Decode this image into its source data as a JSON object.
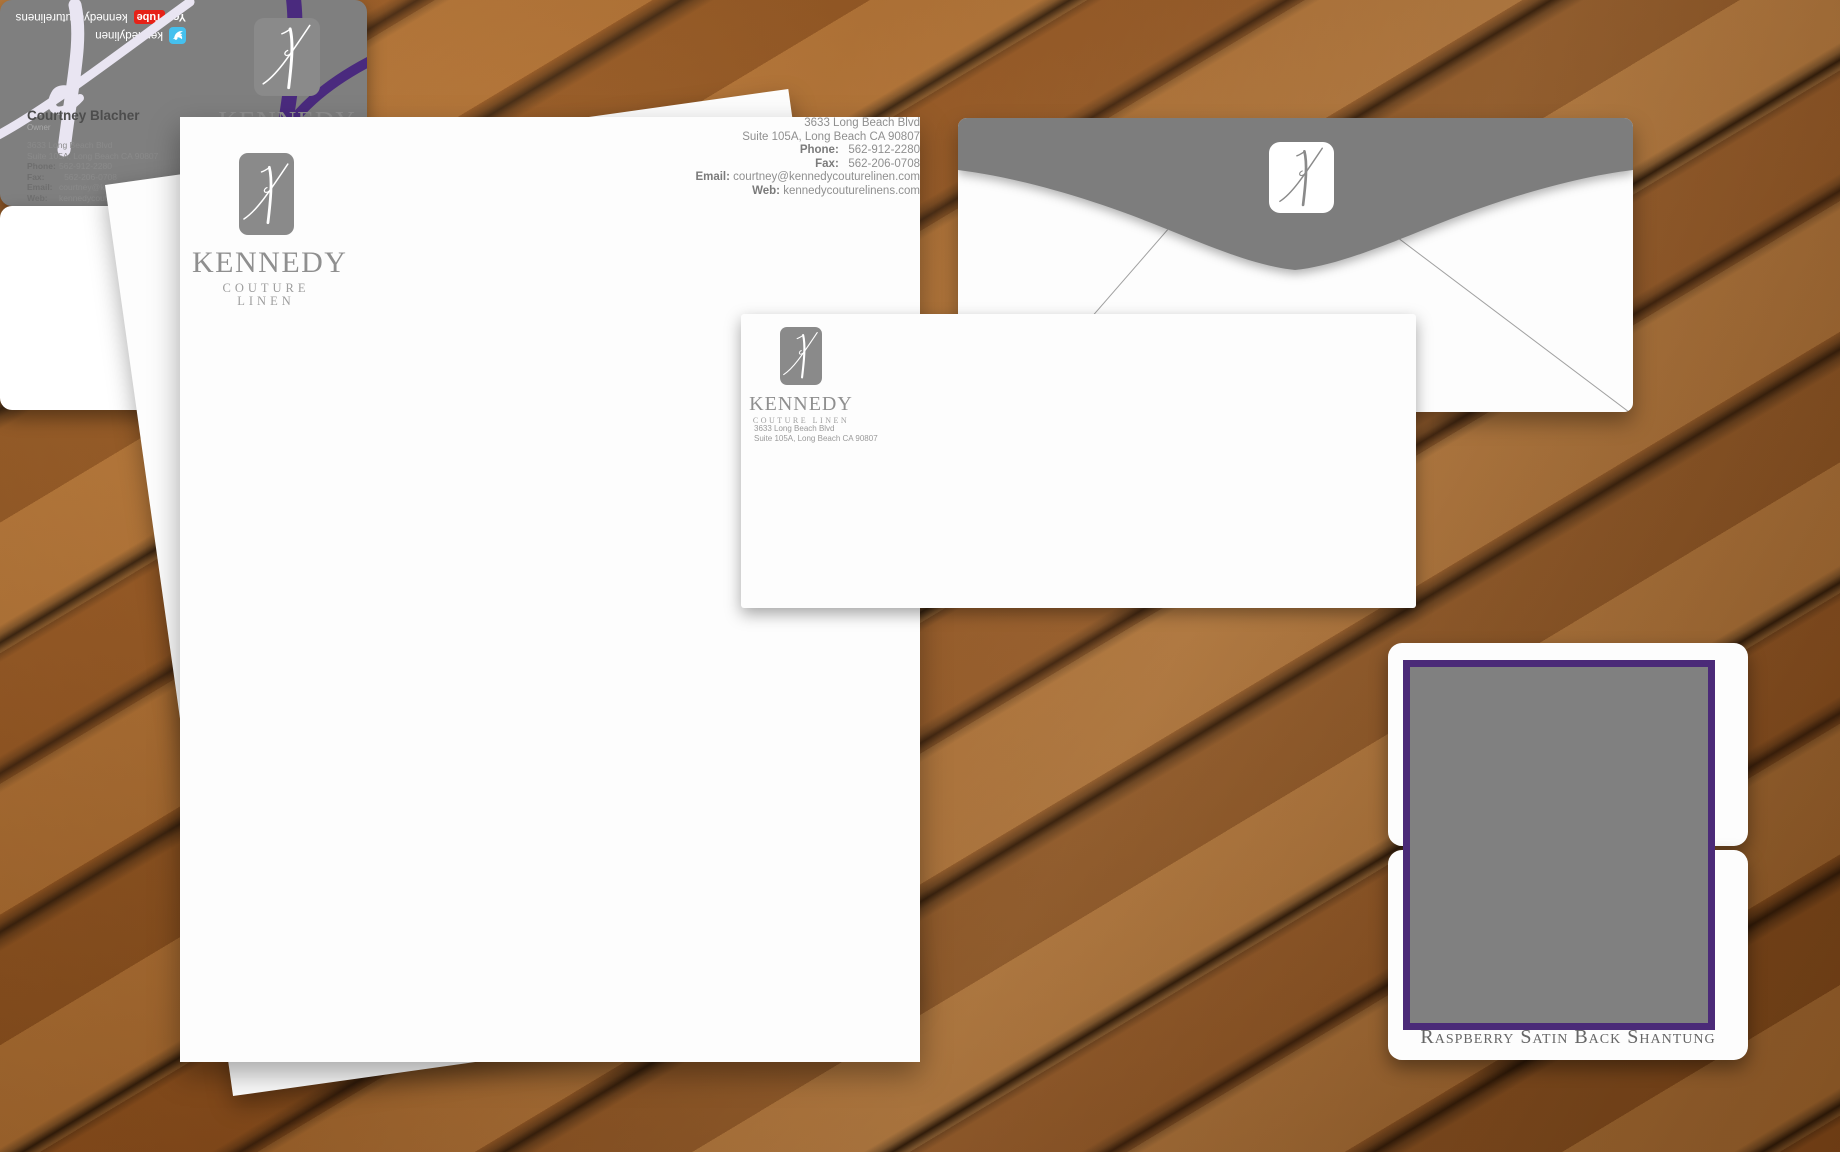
{
  "brand": {
    "name": "KENNEDY",
    "tagline": "COUTURE LINEN",
    "mark": "script-k-icon"
  },
  "contact": {
    "address1": "3633 Long Beach Blvd",
    "address2": "Suite 105A, Long Beach CA 90807",
    "phone_label": "Phone:",
    "phone": "562-912-2280",
    "fax_label": "Fax:",
    "fax": "562-206-0708",
    "email_label": "Email:",
    "email": "courtney@kennedycouturelinen.com",
    "web_label": "Web:",
    "web": "kennedycouturelinens.com"
  },
  "business_card": {
    "name": "Courtney Blacher",
    "title": "Owner"
  },
  "social": {
    "youtube_you": "You",
    "youtube_tube": "Tube",
    "youtube_handle": "kennedycouturelinens",
    "twitter_handle": "kennedylinen"
  },
  "swatch": {
    "caption": "Raspberry Satin Back Shantung"
  },
  "colors": {
    "brand_gray": "#8a8a8a",
    "card_gray": "#7f7f7f",
    "accent_purple": "#4a2a7e",
    "watermark_lavender": "#e9e5f2",
    "twitter_blue": "#45c0ee",
    "youtube_red": "#e62117"
  },
  "icons": {
    "logo": "script-k-icon",
    "youtube": "youtube-logo-icon",
    "twitter": "twitter-bird-icon"
  }
}
